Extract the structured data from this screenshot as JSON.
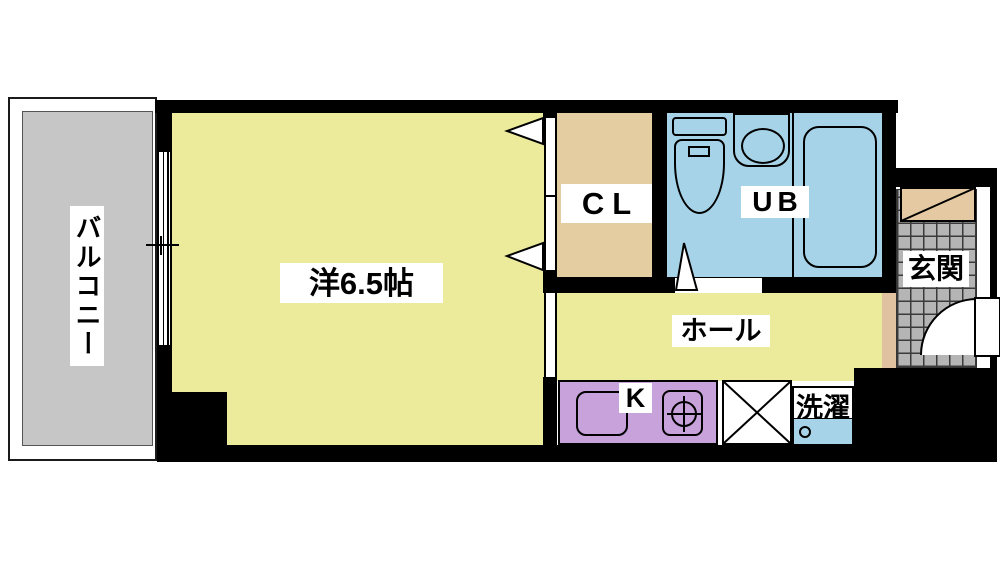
{
  "title": "apartment-floor-plan",
  "rooms": {
    "balcony": "バルコニー",
    "western_room": "洋6.5帖",
    "closet": "CL",
    "unit_bath": "UB",
    "hall": "ホール",
    "kitchen": "K",
    "laundry": "洗濯",
    "entrance": "玄関"
  },
  "colors": {
    "wall": "#000000",
    "room_floor": "#EBEB9B",
    "closet_floor": "#E5CDA2",
    "bath_floor": "#A7D3E8",
    "kitchen_counter": "#C8A2DB",
    "balcony_floor": "#C6C6C6",
    "entrance_tile": "#B5B5B5",
    "entrance_step": "#E0C2A0",
    "shoe_cabinet": "#E5C9A2",
    "washer": "#A7D3E8",
    "label_background": "#FFFFFF"
  }
}
